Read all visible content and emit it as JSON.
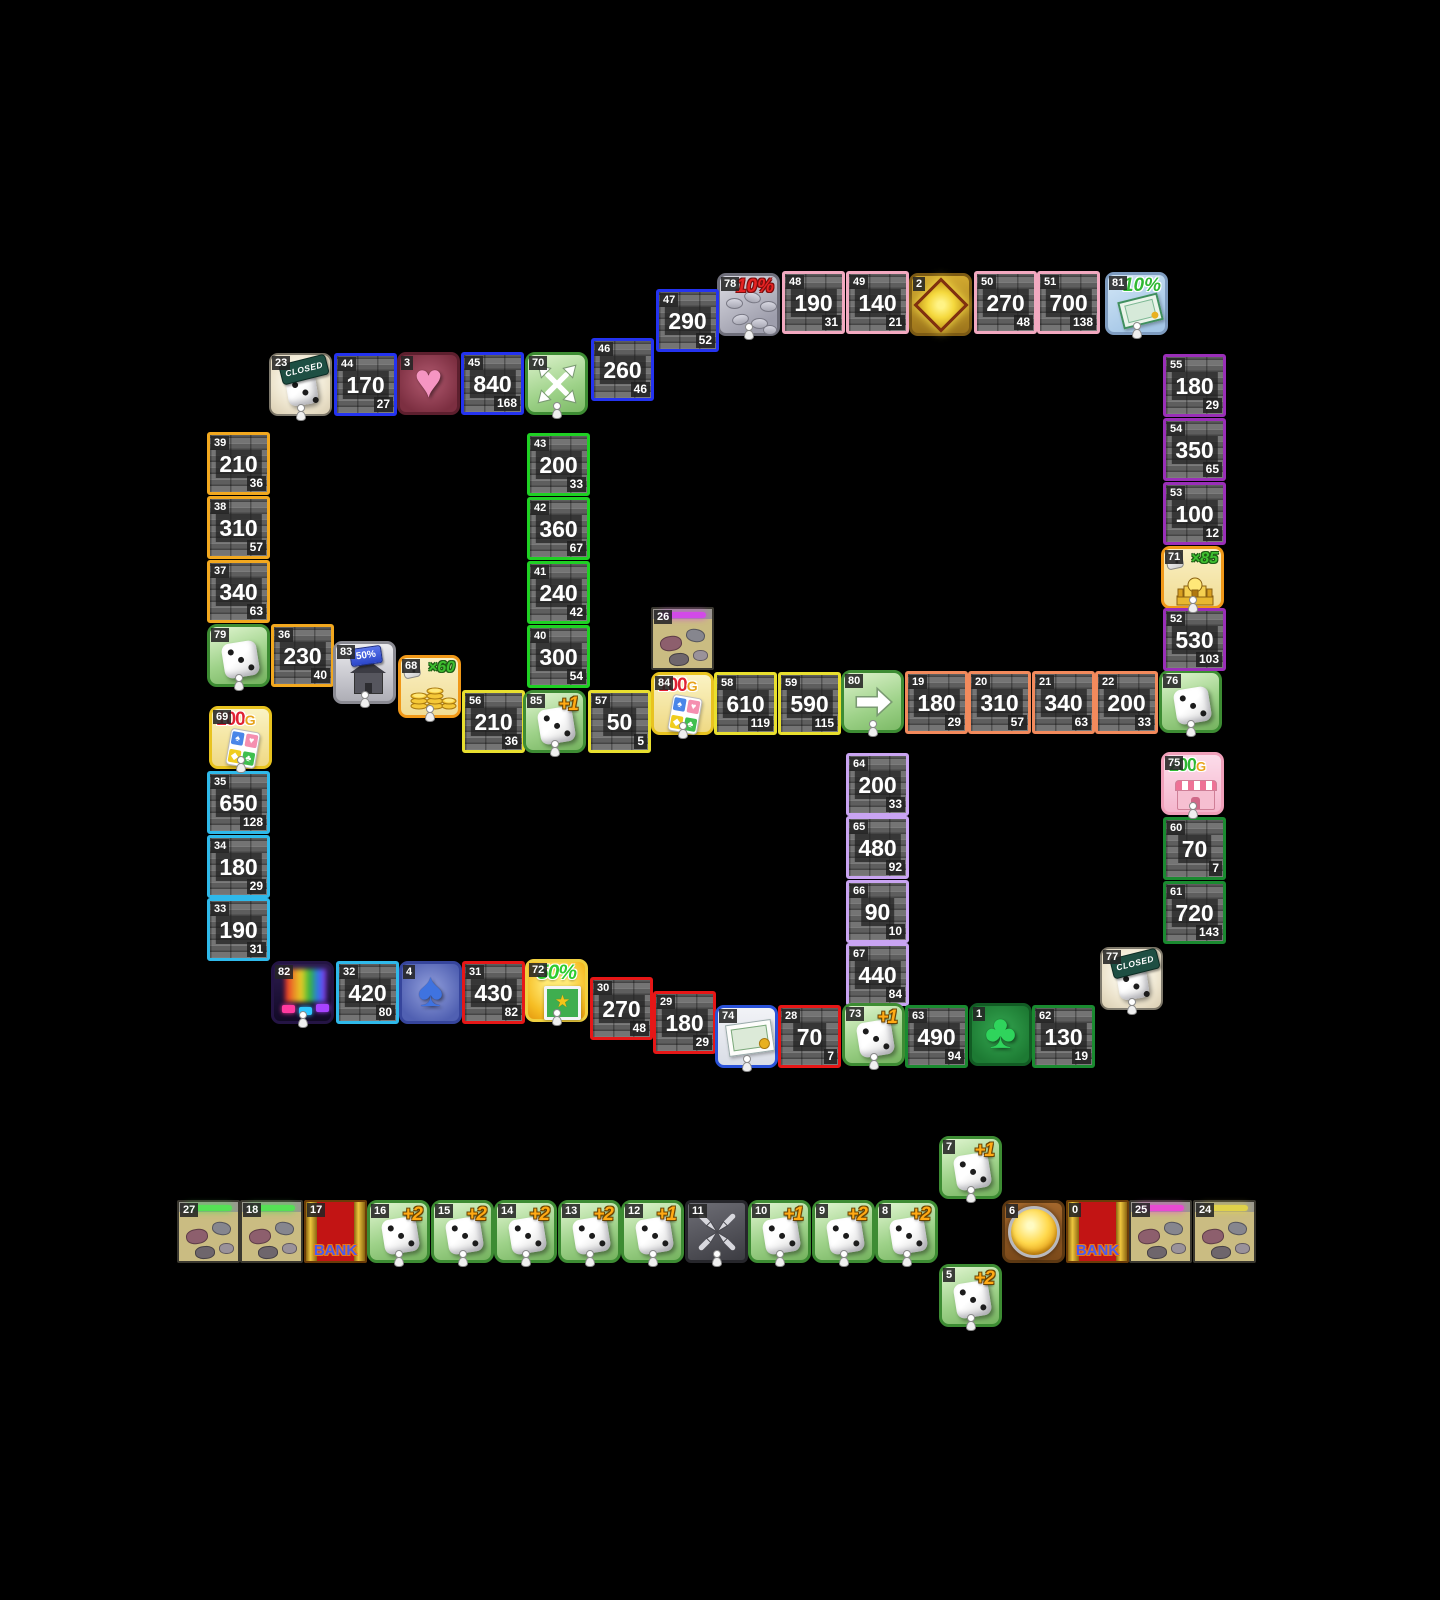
{
  "board": {
    "background": "#000000",
    "tile_size": 63,
    "colors": {
      "pink": "#f2a9c0",
      "blue": "#2433f0",
      "orange": "#f2a81f",
      "green": "#1fd024",
      "yellow": "#e8df2f",
      "salmon": "#f28a5c",
      "purple": "#9a2fb8",
      "cyan": "#2fb9ea",
      "red": "#e61717",
      "lavender": "#c9a4f2",
      "dgreen": "#1a8a30"
    },
    "icon_glyphs": {
      "spade": "♠",
      "heart": "♥",
      "diamond": "◆",
      "club": "♣",
      "star": "★"
    },
    "tiles": [
      {
        "id": "78",
        "x": 717,
        "y": 273,
        "type": "icon",
        "icon": "percent-coins",
        "text": "10%",
        "pawn": true
      },
      {
        "id": "48",
        "x": 782,
        "y": 271,
        "type": "prop",
        "color": "pink",
        "value": "190",
        "sub": "31"
      },
      {
        "id": "49",
        "x": 846,
        "y": 271,
        "type": "prop",
        "color": "pink",
        "value": "140",
        "sub": "21"
      },
      {
        "id": "2",
        "x": 909,
        "y": 273,
        "type": "icon",
        "icon": "diamond"
      },
      {
        "id": "50",
        "x": 974,
        "y": 271,
        "type": "prop",
        "color": "pink",
        "value": "270",
        "sub": "48"
      },
      {
        "id": "51",
        "x": 1037,
        "y": 271,
        "type": "prop",
        "color": "pink",
        "value": "700",
        "sub": "138"
      },
      {
        "id": "81",
        "x": 1105,
        "y": 272,
        "type": "icon",
        "icon": "percent-bill",
        "text": "10%",
        "pawn": true
      },
      {
        "id": "47",
        "x": 656,
        "y": 289,
        "type": "prop",
        "color": "blue",
        "value": "290",
        "sub": "52"
      },
      {
        "id": "46",
        "x": 591,
        "y": 338,
        "type": "prop",
        "color": "blue",
        "value": "260",
        "sub": "46"
      },
      {
        "id": "23",
        "x": 269,
        "y": 353,
        "type": "icon",
        "icon": "dice-closed",
        "text": "CLOSED",
        "pawn": true
      },
      {
        "id": "44",
        "x": 334,
        "y": 353,
        "type": "prop",
        "color": "blue",
        "value": "170",
        "sub": "27"
      },
      {
        "id": "3",
        "x": 397,
        "y": 352,
        "type": "icon",
        "icon": "heart"
      },
      {
        "id": "45",
        "x": 461,
        "y": 352,
        "type": "prop",
        "color": "blue",
        "value": "840",
        "sub": "168"
      },
      {
        "id": "70",
        "x": 525,
        "y": 352,
        "type": "icon",
        "icon": "arrows-out",
        "pawn": true
      },
      {
        "id": "39",
        "x": 207,
        "y": 432,
        "type": "prop",
        "color": "orange",
        "value": "210",
        "sub": "36"
      },
      {
        "id": "38",
        "x": 207,
        "y": 496,
        "type": "prop",
        "color": "orange",
        "value": "310",
        "sub": "57"
      },
      {
        "id": "37",
        "x": 207,
        "y": 560,
        "type": "prop",
        "color": "orange",
        "value": "340",
        "sub": "63"
      },
      {
        "id": "79",
        "x": 207,
        "y": 624,
        "type": "icon",
        "icon": "dice",
        "pawn": true
      },
      {
        "id": "36",
        "x": 271,
        "y": 624,
        "type": "prop",
        "color": "orange",
        "value": "230",
        "sub": "40"
      },
      {
        "id": "43",
        "x": 527,
        "y": 433,
        "type": "prop",
        "color": "green",
        "value": "200",
        "sub": "33"
      },
      {
        "id": "42",
        "x": 527,
        "y": 497,
        "type": "prop",
        "color": "green",
        "value": "360",
        "sub": "67"
      },
      {
        "id": "41",
        "x": 527,
        "y": 561,
        "type": "prop",
        "color": "green",
        "value": "240",
        "sub": "42"
      },
      {
        "id": "40",
        "x": 527,
        "y": 625,
        "type": "prop",
        "color": "green",
        "value": "300",
        "sub": "54"
      },
      {
        "id": "83",
        "x": 333,
        "y": 641,
        "type": "icon",
        "icon": "house-discount",
        "text": "50%",
        "pawn": true
      },
      {
        "id": "68",
        "x": 398,
        "y": 655,
        "type": "icon",
        "icon": "mult-coins",
        "text": "×60",
        "pawn": true
      },
      {
        "id": "56",
        "x": 462,
        "y": 690,
        "type": "prop",
        "color": "yellow",
        "value": "210",
        "sub": "36"
      },
      {
        "id": "85",
        "x": 523,
        "y": 690,
        "type": "icon",
        "icon": "dice",
        "text": "+1",
        "pawn": true
      },
      {
        "id": "57",
        "x": 588,
        "y": 690,
        "type": "prop",
        "color": "yellow",
        "value": "50",
        "sub": "5"
      },
      {
        "id": "26",
        "x": 651,
        "y": 607,
        "type": "icon",
        "icon": "rubble",
        "glow": "#d24ae8"
      },
      {
        "id": "84",
        "x": 651,
        "y": 672,
        "type": "icon",
        "icon": "cards-bonus",
        "text": "100",
        "suffix": "G",
        "pawn": true
      },
      {
        "id": "58",
        "x": 714,
        "y": 672,
        "type": "prop",
        "color": "yellow",
        "value": "610",
        "sub": "119"
      },
      {
        "id": "59",
        "x": 778,
        "y": 672,
        "type": "prop",
        "color": "yellow",
        "value": "590",
        "sub": "115"
      },
      {
        "id": "80",
        "x": 841,
        "y": 670,
        "type": "icon",
        "icon": "arrow-right",
        "pawn": true
      },
      {
        "id": "19",
        "x": 905,
        "y": 671,
        "type": "prop",
        "color": "salmon",
        "value": "180",
        "sub": "29"
      },
      {
        "id": "20",
        "x": 968,
        "y": 671,
        "type": "prop",
        "color": "salmon",
        "value": "310",
        "sub": "57"
      },
      {
        "id": "21",
        "x": 1032,
        "y": 671,
        "type": "prop",
        "color": "salmon",
        "value": "340",
        "sub": "63"
      },
      {
        "id": "22",
        "x": 1095,
        "y": 671,
        "type": "prop",
        "color": "salmon",
        "value": "200",
        "sub": "33"
      },
      {
        "id": "76",
        "x": 1159,
        "y": 670,
        "type": "icon",
        "icon": "dice",
        "pawn": true
      },
      {
        "id": "55",
        "x": 1163,
        "y": 354,
        "type": "prop",
        "color": "purple",
        "value": "180",
        "sub": "29"
      },
      {
        "id": "54",
        "x": 1163,
        "y": 418,
        "type": "prop",
        "color": "purple",
        "value": "350",
        "sub": "65"
      },
      {
        "id": "53",
        "x": 1163,
        "y": 482,
        "type": "prop",
        "color": "purple",
        "value": "100",
        "sub": "12"
      },
      {
        "id": "71",
        "x": 1161,
        "y": 546,
        "type": "icon",
        "icon": "mult-palace",
        "text": "×85",
        "pawn": true
      },
      {
        "id": "52",
        "x": 1163,
        "y": 608,
        "type": "prop",
        "color": "purple",
        "value": "530",
        "sub": "103"
      },
      {
        "id": "69",
        "x": 209,
        "y": 706,
        "type": "icon",
        "icon": "cards-bonus",
        "text": "100",
        "suffix": "G",
        "pawn": true
      },
      {
        "id": "35",
        "x": 207,
        "y": 771,
        "type": "prop",
        "color": "cyan",
        "value": "650",
        "sub": "128"
      },
      {
        "id": "34",
        "x": 207,
        "y": 835,
        "type": "prop",
        "color": "cyan",
        "value": "180",
        "sub": "29"
      },
      {
        "id": "33",
        "x": 207,
        "y": 898,
        "type": "prop",
        "color": "cyan",
        "value": "190",
        "sub": "31"
      },
      {
        "id": "75",
        "x": 1161,
        "y": 752,
        "type": "icon",
        "icon": "shop-bonus",
        "text": "200",
        "suffix": "G",
        "pawn": true
      },
      {
        "id": "60",
        "x": 1163,
        "y": 817,
        "type": "prop",
        "color": "dgreen",
        "value": "70",
        "sub": "7"
      },
      {
        "id": "61",
        "x": 1163,
        "y": 881,
        "type": "prop",
        "color": "dgreen",
        "value": "720",
        "sub": "143"
      },
      {
        "id": "77",
        "x": 1100,
        "y": 947,
        "type": "icon",
        "icon": "dice-closed",
        "text": "CLOSED",
        "pawn": true
      },
      {
        "id": "64",
        "x": 846,
        "y": 753,
        "type": "prop",
        "color": "lavender",
        "value": "200",
        "sub": "33"
      },
      {
        "id": "65",
        "x": 846,
        "y": 816,
        "type": "prop",
        "color": "lavender",
        "value": "480",
        "sub": "92"
      },
      {
        "id": "66",
        "x": 846,
        "y": 880,
        "type": "prop",
        "color": "lavender",
        "value": "90",
        "sub": "10"
      },
      {
        "id": "67",
        "x": 846,
        "y": 943,
        "type": "prop",
        "color": "lavender",
        "value": "440",
        "sub": "84"
      },
      {
        "id": "82",
        "x": 271,
        "y": 961,
        "type": "icon",
        "icon": "stage",
        "pawn": true
      },
      {
        "id": "32",
        "x": 336,
        "y": 961,
        "type": "prop",
        "color": "cyan",
        "value": "420",
        "sub": "80"
      },
      {
        "id": "4",
        "x": 399,
        "y": 961,
        "type": "icon",
        "icon": "spade"
      },
      {
        "id": "31",
        "x": 462,
        "y": 961,
        "type": "prop",
        "color": "red",
        "value": "430",
        "sub": "82"
      },
      {
        "id": "72",
        "x": 525,
        "y": 959,
        "type": "icon",
        "icon": "star-discount",
        "text": "50%",
        "pawn": true
      },
      {
        "id": "30",
        "x": 590,
        "y": 977,
        "type": "prop",
        "color": "red",
        "value": "270",
        "sub": "48"
      },
      {
        "id": "29",
        "x": 653,
        "y": 991,
        "type": "prop",
        "color": "red",
        "value": "180",
        "sub": "29"
      },
      {
        "id": "74",
        "x": 715,
        "y": 1005,
        "type": "icon",
        "icon": "banknote",
        "pawn": true
      },
      {
        "id": "28",
        "x": 778,
        "y": 1005,
        "type": "prop",
        "color": "red",
        "value": "70",
        "sub": "7"
      },
      {
        "id": "73",
        "x": 842,
        "y": 1003,
        "type": "icon",
        "icon": "dice",
        "text": "+1",
        "pawn": true
      },
      {
        "id": "63",
        "x": 905,
        "y": 1005,
        "type": "prop",
        "color": "dgreen",
        "value": "490",
        "sub": "94"
      },
      {
        "id": "1",
        "x": 969,
        "y": 1003,
        "type": "icon",
        "icon": "club"
      },
      {
        "id": "62",
        "x": 1032,
        "y": 1005,
        "type": "prop",
        "color": "dgreen",
        "value": "130",
        "sub": "19"
      },
      {
        "id": "27",
        "x": 177,
        "y": 1200,
        "type": "icon",
        "icon": "rubble",
        "glow": "#55e055"
      },
      {
        "id": "18",
        "x": 240,
        "y": 1200,
        "type": "icon",
        "icon": "rubble",
        "glow": "#55e055"
      },
      {
        "id": "17",
        "x": 304,
        "y": 1200,
        "type": "icon",
        "icon": "bank",
        "text": "BANK"
      },
      {
        "id": "16",
        "x": 367,
        "y": 1200,
        "type": "icon",
        "icon": "dice",
        "text": "+2",
        "pawn": true
      },
      {
        "id": "15",
        "x": 431,
        "y": 1200,
        "type": "icon",
        "icon": "dice",
        "text": "+2",
        "pawn": true
      },
      {
        "id": "14",
        "x": 494,
        "y": 1200,
        "type": "icon",
        "icon": "dice",
        "text": "+2",
        "pawn": true
      },
      {
        "id": "13",
        "x": 558,
        "y": 1200,
        "type": "icon",
        "icon": "dice",
        "text": "+2",
        "pawn": true
      },
      {
        "id": "12",
        "x": 621,
        "y": 1200,
        "type": "icon",
        "icon": "dice",
        "text": "+1",
        "pawn": true
      },
      {
        "id": "11",
        "x": 685,
        "y": 1200,
        "type": "icon",
        "icon": "arrows-in",
        "pawn": true
      },
      {
        "id": "10",
        "x": 748,
        "y": 1200,
        "type": "icon",
        "icon": "dice",
        "text": "+1",
        "pawn": true
      },
      {
        "id": "9",
        "x": 812,
        "y": 1200,
        "type": "icon",
        "icon": "dice",
        "text": "+2",
        "pawn": true
      },
      {
        "id": "8",
        "x": 875,
        "y": 1200,
        "type": "icon",
        "icon": "dice",
        "text": "+2",
        "pawn": true
      },
      {
        "id": "7",
        "x": 939,
        "y": 1136,
        "type": "icon",
        "icon": "dice",
        "text": "+1",
        "pawn": true
      },
      {
        "id": "5",
        "x": 939,
        "y": 1264,
        "type": "icon",
        "icon": "dice",
        "text": "+2",
        "pawn": true
      },
      {
        "id": "6",
        "x": 1002,
        "y": 1200,
        "type": "icon",
        "icon": "button"
      },
      {
        "id": "0",
        "x": 1066,
        "y": 1200,
        "type": "icon",
        "icon": "bank",
        "text": "BANK"
      },
      {
        "id": "25",
        "x": 1129,
        "y": 1200,
        "type": "icon",
        "icon": "rubble",
        "glow": "#e84ad2"
      },
      {
        "id": "24",
        "x": 1193,
        "y": 1200,
        "type": "icon",
        "icon": "rubble",
        "glow": "#e0d24a"
      }
    ]
  }
}
